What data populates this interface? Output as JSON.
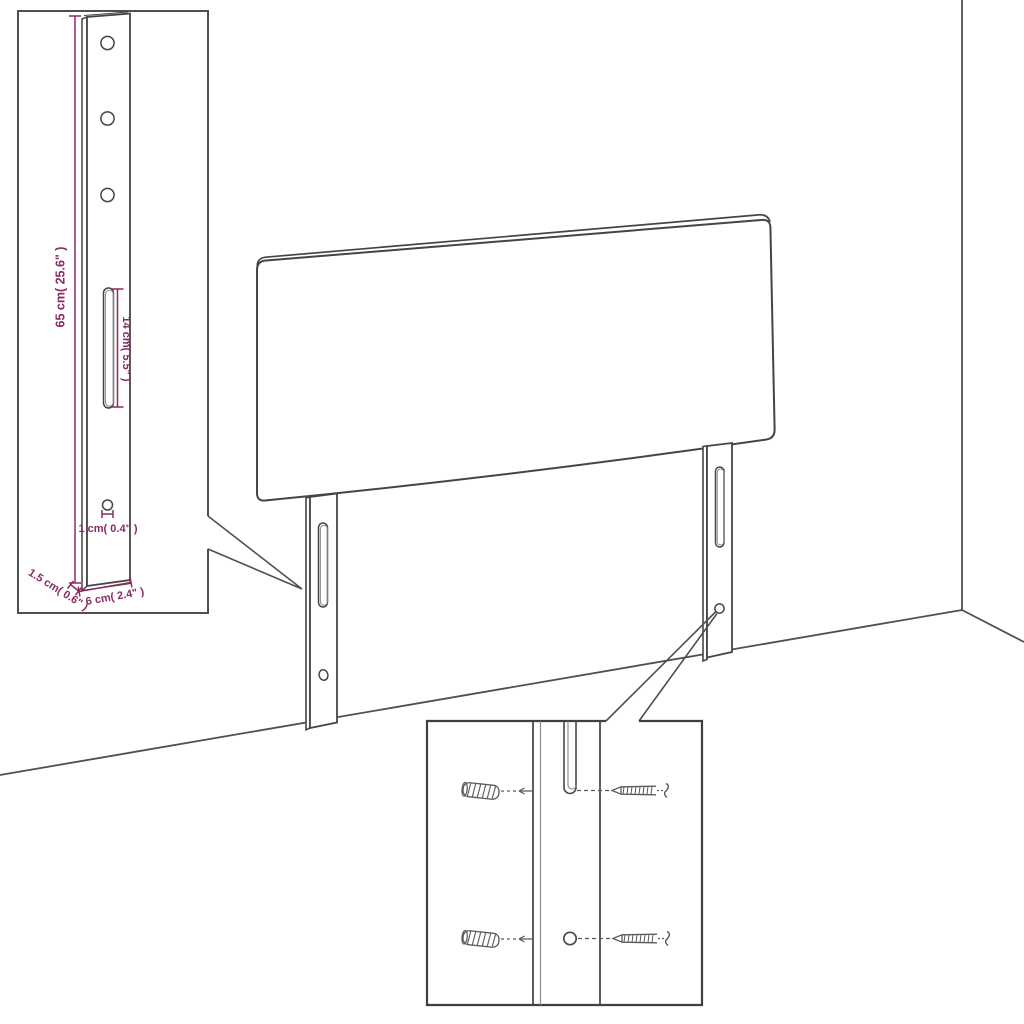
{
  "figure": {
    "kind": "furniture-assembly-dimension-diagram",
    "subject": "upholstered headboard with two slotted mounting legs, wall corner backdrop",
    "colors": {
      "background": "#ffffff",
      "line_art": "#4a4a4a",
      "dimension": "#8a2b63"
    },
    "leg_detail_inset": {
      "labels": {
        "leg_height": "65 cm( 25.6\" )",
        "slot_length": "14 cm( 5.5\" )",
        "hole_diameter": "1 cm( 0.4\" )",
        "leg_depth": "1.5 cm( 0.6\" )",
        "leg_width": "6 cm( 2.4\" )"
      }
    },
    "mounting_detail_inset": {
      "parts": {
        "wall_plugs": 2,
        "screws": 2
      }
    }
  }
}
